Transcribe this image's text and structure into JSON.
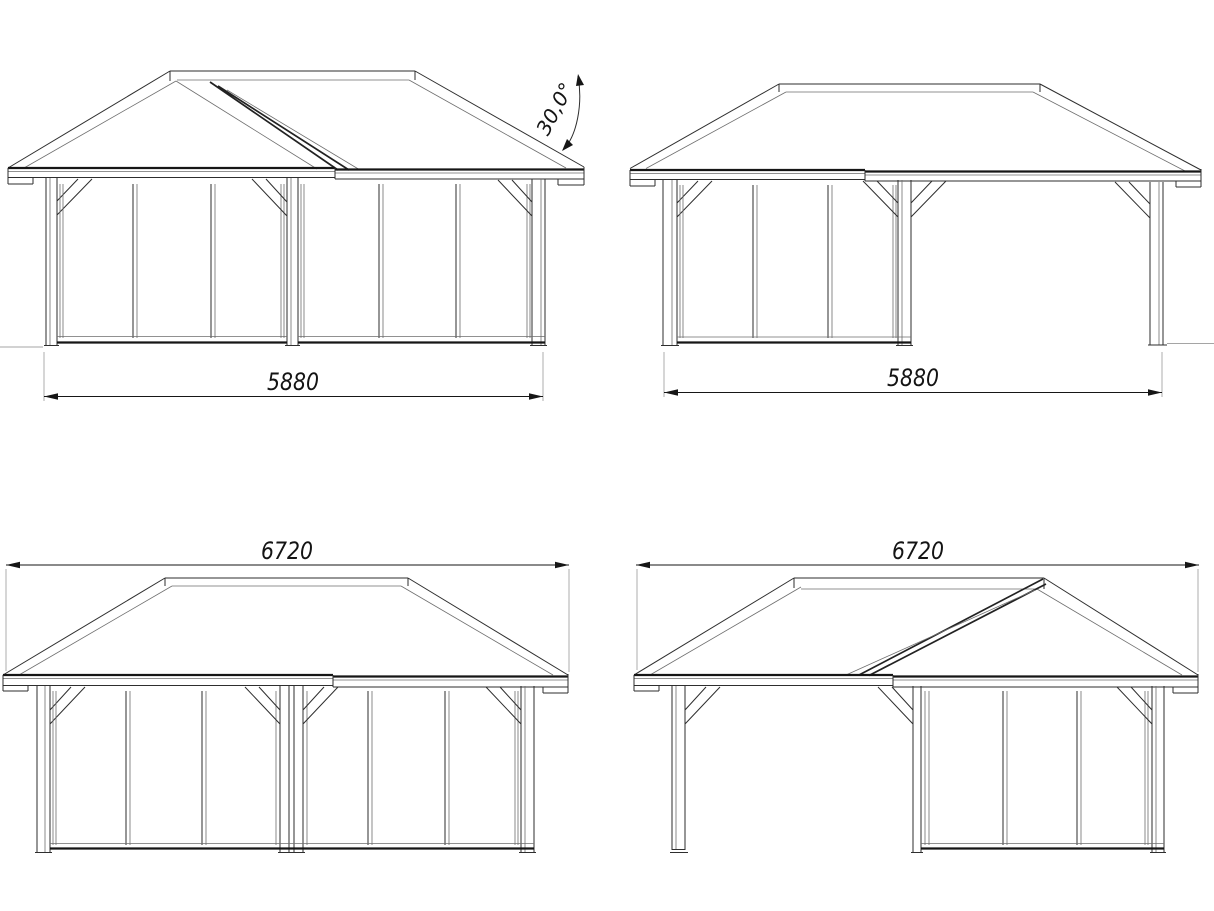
{
  "drawing": {
    "title": "Pavilion elevation drawings",
    "angle": {
      "label": "30,0°"
    },
    "views": [
      {
        "name": "front-elevation-enclosed",
        "dimension_label": "5880"
      },
      {
        "name": "front-elevation-with-open-bay",
        "dimension_label": "5880"
      },
      {
        "name": "side-elevation-enclosed",
        "dimension_label": "6720"
      },
      {
        "name": "side-elevation-gable-open-bay",
        "dimension_label": "6720"
      }
    ],
    "colors": {
      "background": "#ffffff",
      "line": "#2e2e2e",
      "thick_line": "#161616",
      "thin_line": "#6e6e6e",
      "extension_line": "#a5a5a5"
    }
  }
}
